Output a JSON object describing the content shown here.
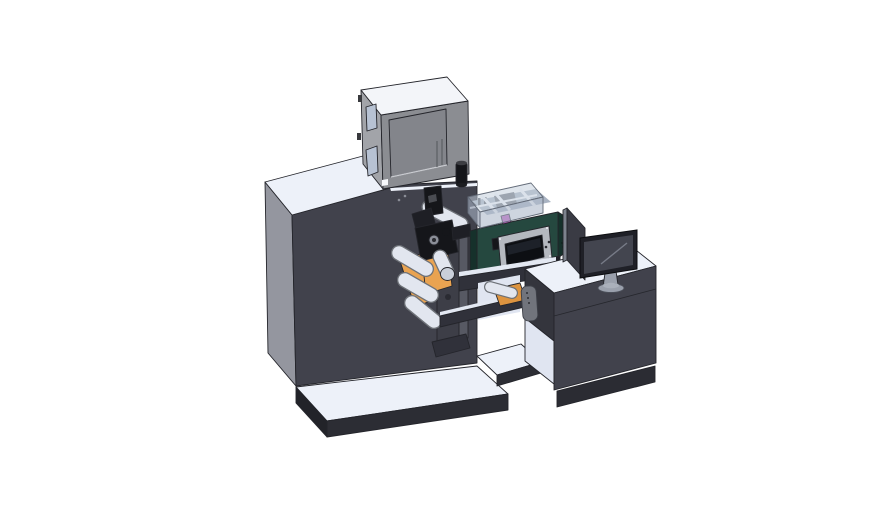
{
  "meta": {
    "canvas": {
      "width": 888,
      "height": 522
    },
    "scene_label": "3d-cad-render-label-printing-machine-with-desk-and-monitor"
  },
  "palette": {
    "background": "#ffffff",
    "outline": "#24252b",
    "machine_dark": "#41424c",
    "machine_side": "#94969f",
    "surface_light": "#edf1f9",
    "base_dark": "#2c2d34",
    "base_darker": "#222329",
    "box_top": "#f3f5f9",
    "box_side": "#a2a4a9",
    "box_front": "#8b8d92",
    "box_panel": "#83858b",
    "box_panel_hl": "#c9cbd0",
    "window_glass": "#b7c2d3",
    "black_part": "#15161a",
    "black_part2": "#1e1f25",
    "metal_gray": "#8b8f98",
    "plate": "#3d3e47",
    "plate_side": "#575963",
    "orange": "#e9a351",
    "orange_dark": "#a9762f",
    "orange2": "#dd9440",
    "roller_fill": "#e2e6ef",
    "roller_outline": "#6e7278",
    "roller_end": "#c9cfda",
    "teal": "#25483f",
    "teal_dark": "#16312b",
    "bezel": "#b4b8bf",
    "screen_black": "#0d0f13",
    "screen_hl": "#1d2129",
    "magenta": "#c455c4",
    "cover_top": "rgba(197,207,221,0.55)",
    "cover_front": "rgba(176,188,204,0.62)",
    "cover_left": "rgba(152,163,180,0.7)",
    "cover_stroke": "#646c79",
    "strip_light": "#e3e8f2",
    "beam_dark": "#30313a",
    "inner_light": "#e0e5f1",
    "handle": "#71747c",
    "desk_side": "#34353d",
    "plinth": "#2b2c33",
    "panel": "#3a3b44",
    "panel_edge": "#7d828d",
    "mon_bezel": "#1f2027",
    "mon_screen": "#43454f",
    "mon_hl": "#777b87",
    "stand": "#9aa0ac",
    "white_bar": "#f7f9fc",
    "interior": "#a9b3c2",
    "interior_blob": "#6d727b",
    "speaker_dot": "#10211c",
    "seam": "#26272d"
  },
  "scene": {
    "parts": [
      {
        "name": "machine-body",
        "color_key": "machine_dark"
      },
      {
        "name": "control-cabinet",
        "color_key": "box_front"
      },
      {
        "name": "base-platform",
        "color_key": "surface_light"
      },
      {
        "name": "label-rolls",
        "color_key": "orange"
      },
      {
        "name": "guide-rollers",
        "color_key": "roller_fill"
      },
      {
        "name": "print-mechanism",
        "color_key": "black_part"
      },
      {
        "name": "unwind-plate",
        "color_key": "plate"
      },
      {
        "name": "inkjet-unit",
        "color_key": "teal"
      },
      {
        "name": "unit-display",
        "color_key": "screen_black"
      },
      {
        "name": "protective-cover",
        "color_key": "cover_top"
      },
      {
        "name": "bridge-frame",
        "color_key": "beam_dark"
      },
      {
        "name": "tension-handle",
        "color_key": "handle"
      },
      {
        "name": "operator-desk",
        "color_key": "machine_dark"
      },
      {
        "name": "monitor",
        "color_key": "mon_bezel"
      },
      {
        "name": "rear-panel",
        "color_key": "panel"
      }
    ]
  }
}
